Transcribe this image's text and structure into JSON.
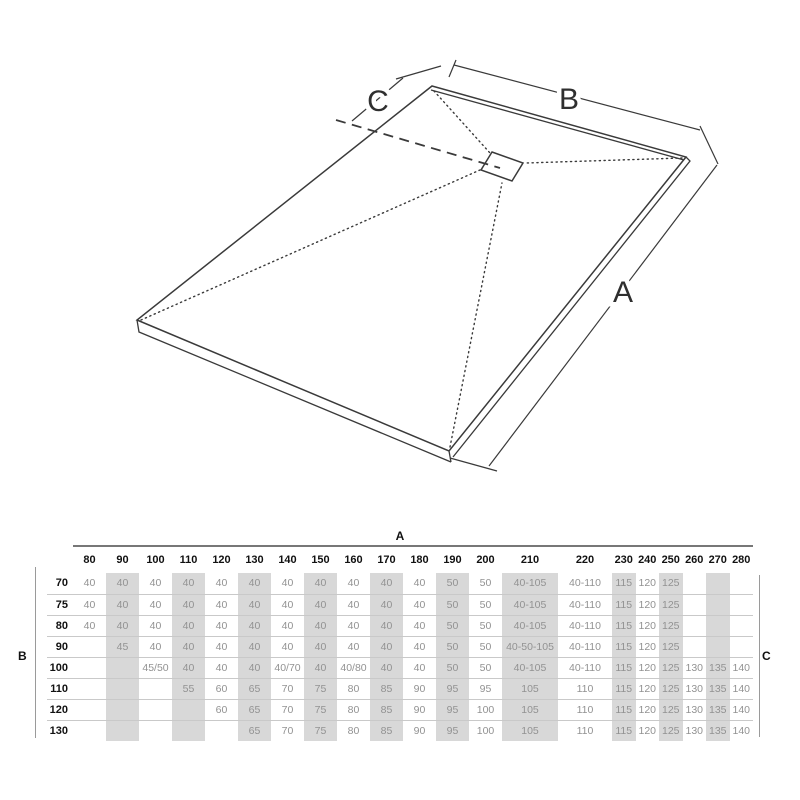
{
  "diagram": {
    "labels": {
      "a": "A",
      "b": "B",
      "c": "C"
    }
  },
  "table": {
    "axis_top_label": "A",
    "axis_left_label": "B",
    "axis_right_label": "C",
    "columns": [
      "80",
      "90",
      "100",
      "110",
      "120",
      "130",
      "140",
      "150",
      "160",
      "170",
      "180",
      "190",
      "200",
      "210",
      "220",
      "230",
      "240",
      "250",
      "260",
      "270",
      "280"
    ],
    "shaded_columns": [
      "90",
      "110",
      "130",
      "150",
      "170",
      "190",
      "210",
      "230",
      "250",
      "270"
    ],
    "rows": [
      {
        "label": "70",
        "values": [
          "40",
          "40",
          "40",
          "40",
          "40",
          "40",
          "40",
          "40",
          "40",
          "40",
          "40",
          "50",
          "50",
          "40-105",
          "40-110",
          "115",
          "120",
          "125",
          "",
          "",
          ""
        ]
      },
      {
        "label": "75",
        "values": [
          "40",
          "40",
          "40",
          "40",
          "40",
          "40",
          "40",
          "40",
          "40",
          "40",
          "40",
          "50",
          "50",
          "40-105",
          "40-110",
          "115",
          "120",
          "125",
          "",
          "",
          ""
        ]
      },
      {
        "label": "80",
        "values": [
          "40",
          "40",
          "40",
          "40",
          "40",
          "40",
          "40",
          "40",
          "40",
          "40",
          "40",
          "50",
          "50",
          "40-105",
          "40-110",
          "115",
          "120",
          "125",
          "",
          "",
          ""
        ]
      },
      {
        "label": "90",
        "values": [
          "",
          "45",
          "40",
          "40",
          "40",
          "40",
          "40",
          "40",
          "40",
          "40",
          "40",
          "50",
          "50",
          "40-50-105",
          "40-110",
          "115",
          "120",
          "125",
          "",
          "",
          ""
        ]
      },
      {
        "label": "100",
        "values": [
          "",
          "",
          "45/50",
          "40",
          "40",
          "40",
          "40/70",
          "40",
          "40/80",
          "40",
          "40",
          "50",
          "50",
          "40-105",
          "40-110",
          "115",
          "120",
          "125",
          "130",
          "135",
          "140"
        ]
      },
      {
        "label": "110",
        "values": [
          "",
          "",
          "",
          "55",
          "60",
          "65",
          "70",
          "75",
          "80",
          "85",
          "90",
          "95",
          "95",
          "105",
          "110",
          "115",
          "120",
          "125",
          "130",
          "135",
          "140"
        ]
      },
      {
        "label": "120",
        "values": [
          "",
          "",
          "",
          "",
          "60",
          "65",
          "70",
          "75",
          "80",
          "85",
          "90",
          "95",
          "100",
          "105",
          "110",
          "115",
          "120",
          "125",
          "130",
          "135",
          "140"
        ]
      },
      {
        "label": "130",
        "values": [
          "",
          "",
          "",
          "",
          "",
          "65",
          "70",
          "75",
          "80",
          "85",
          "90",
          "95",
          "100",
          "105",
          "110",
          "115",
          "120",
          "125",
          "130",
          "135",
          "140"
        ]
      }
    ]
  },
  "colors": {
    "shaded_cell": "#d8d8d8",
    "value_text": "#929292",
    "header_text": "#111111",
    "line": "#3a3a3a"
  }
}
